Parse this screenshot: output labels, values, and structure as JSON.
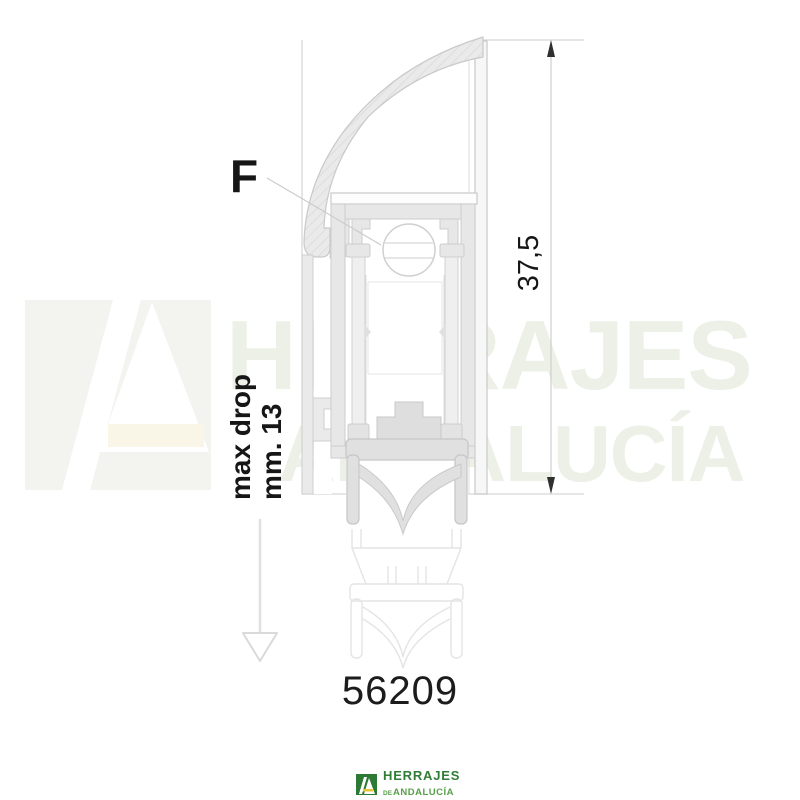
{
  "diagram": {
    "force_label": "F",
    "max_drop": {
      "line1": "max drop",
      "line2": "mm. 13"
    },
    "height_mm": "37,5",
    "product_code": "56209"
  },
  "watermark": {
    "word1": "HERRAJES",
    "word2": "ANDALUCÍA"
  },
  "logo": {
    "brand": "HERRAJES",
    "de": "DE",
    "region": "ANDALUCÍA"
  },
  "icons": {
    "drop_direction": "open-triangle-down-arrow",
    "dimension_ends": "filled-triangle-arrowheads",
    "brand_mark": "green-square-stylized-A"
  },
  "colors": {
    "brand_green": "#2c7a33",
    "brand_text_green": "#2f7d36",
    "brand_text_light_green": "#56a049",
    "drawing_outline_gray": "#c9c9c9",
    "annotation_black": "#161616",
    "watermark_tint": "#edf0e7"
  }
}
